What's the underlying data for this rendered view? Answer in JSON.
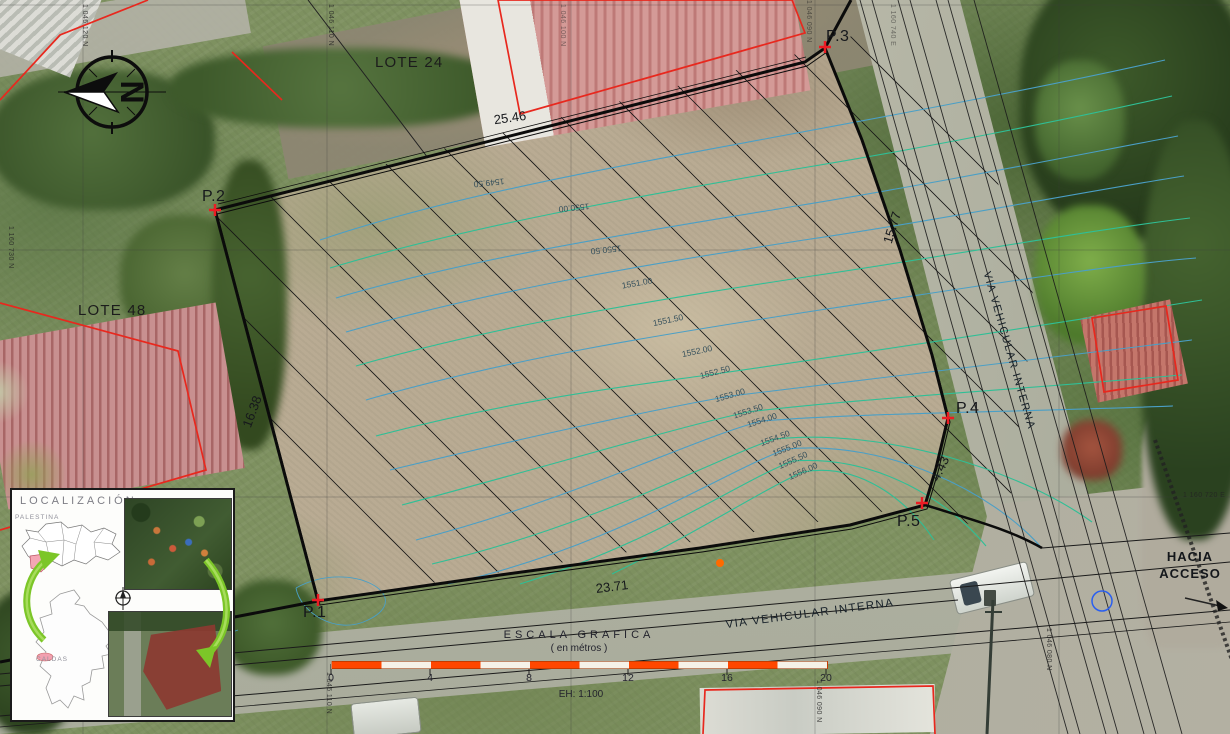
{
  "plan": {
    "lots": {
      "lote24": "LOTE 24",
      "lote48": "LOTE 48"
    },
    "points": [
      {
        "label": "P.1"
      },
      {
        "label": "P.2"
      },
      {
        "label": "P.3"
      },
      {
        "label": "P.4"
      },
      {
        "label": "P.5"
      }
    ],
    "dimensions": [
      {
        "label": "25.46"
      },
      {
        "label": "15.77"
      },
      {
        "label": "4.43"
      },
      {
        "label": "23.71"
      },
      {
        "label": "16.38"
      }
    ],
    "roads": {
      "right_label": "VIA VEHICULAR INTERNA",
      "bottom_label": "VIA VEHICULAR INTERNA"
    },
    "access": {
      "line1": "HACIA",
      "line2": "ACCESO"
    },
    "north_letter": "N",
    "contour_labels": [
      "1549.50",
      "1550.00",
      "1550.50",
      "1551.00",
      "1551.50",
      "1552.00",
      "1552.50",
      "1553.00",
      "1553.50",
      "1554.00",
      "1554.50",
      "1555.00",
      "1555.50",
      "1556.00"
    ],
    "grid_labels": [
      {
        "text": "1 046 120 N"
      },
      {
        "text": "1 046 110 N"
      },
      {
        "text": "1 046 100 N"
      },
      {
        "text": "1 046 090 N"
      },
      {
        "text": "1 160 740 E"
      },
      {
        "text": "1 160 730 N"
      },
      {
        "text": "1 160 720 E"
      },
      {
        "text": "1 046 110 N"
      },
      {
        "text": "1 046 090 N"
      },
      {
        "text": "1 046 080 N"
      }
    ],
    "scale_bar": {
      "title": "ESCALA GRAFICA",
      "subtitle": "( en métros )",
      "ticks": [
        "0",
        "4",
        "8",
        "12",
        "16",
        "20"
      ],
      "ratio_label": "EH: 1:100"
    },
    "inset": {
      "title": "LOCALIZACIÓN:",
      "dept_label": "PALESTINA",
      "country_label": "CALDAS"
    }
  },
  "colors": {
    "boundary": "#0b0b0b",
    "contour_blue": "#4a9fc6",
    "contour_teal": "#2fbf96",
    "point_marker": "#ec1c24",
    "building_outline": "#e8281e",
    "scalebar_orange": "#ff4700",
    "inset_arrow": "#7cc628"
  }
}
